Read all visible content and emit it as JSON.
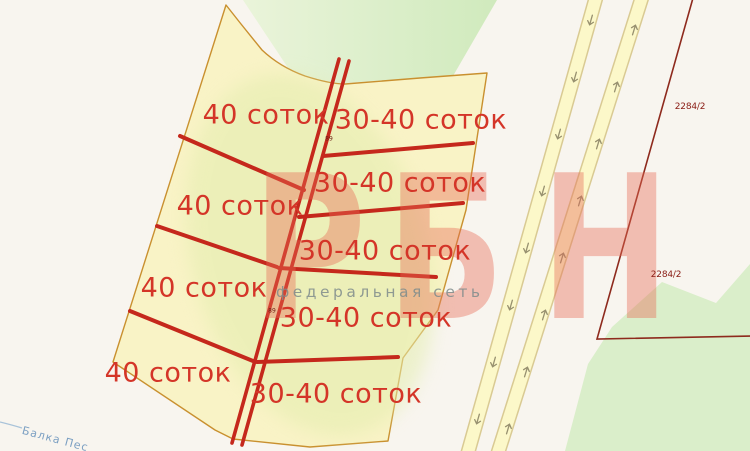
{
  "watermark": {
    "brand": "РБН",
    "letters": [
      "Р",
      "Б",
      "Н"
    ],
    "tagline": "федеральная сеть"
  },
  "parcels": {
    "left": [
      {
        "label": "40 соток"
      },
      {
        "label": "40 соток"
      },
      {
        "label": "40 соток"
      },
      {
        "label": "40 соток"
      }
    ],
    "right": [
      {
        "label": "30-40 соток"
      },
      {
        "label": "30-40 соток"
      },
      {
        "label": "30-40 соток"
      },
      {
        "label": "30-40 соток"
      },
      {
        "label": "30-40 соток"
      }
    ]
  },
  "cadastral_labels": [
    {
      "text": "2284/2"
    },
    {
      "text": "2284/2"
    }
  ],
  "road_numbers": [
    {
      "text": "89"
    },
    {
      "text": "89"
    }
  ],
  "stream": {
    "label": "Балка Пес"
  },
  "icons": {
    "road_arrow": "direction-arrow"
  },
  "colors": {
    "background": "#f8f5ef",
    "parcel_fill": "#f9f3c6",
    "parcel_border": "#c9902f",
    "divider_red": "#c5281c",
    "label_red": "#d43528",
    "boundary_dark_red": "#8e2a1d",
    "green_area": "#d7edc6",
    "road_fill": "#fcf8c9",
    "road_casing": "#d9ca93",
    "watermark_pink": "#e86a55",
    "stream_blue": "#a9c3d9"
  }
}
